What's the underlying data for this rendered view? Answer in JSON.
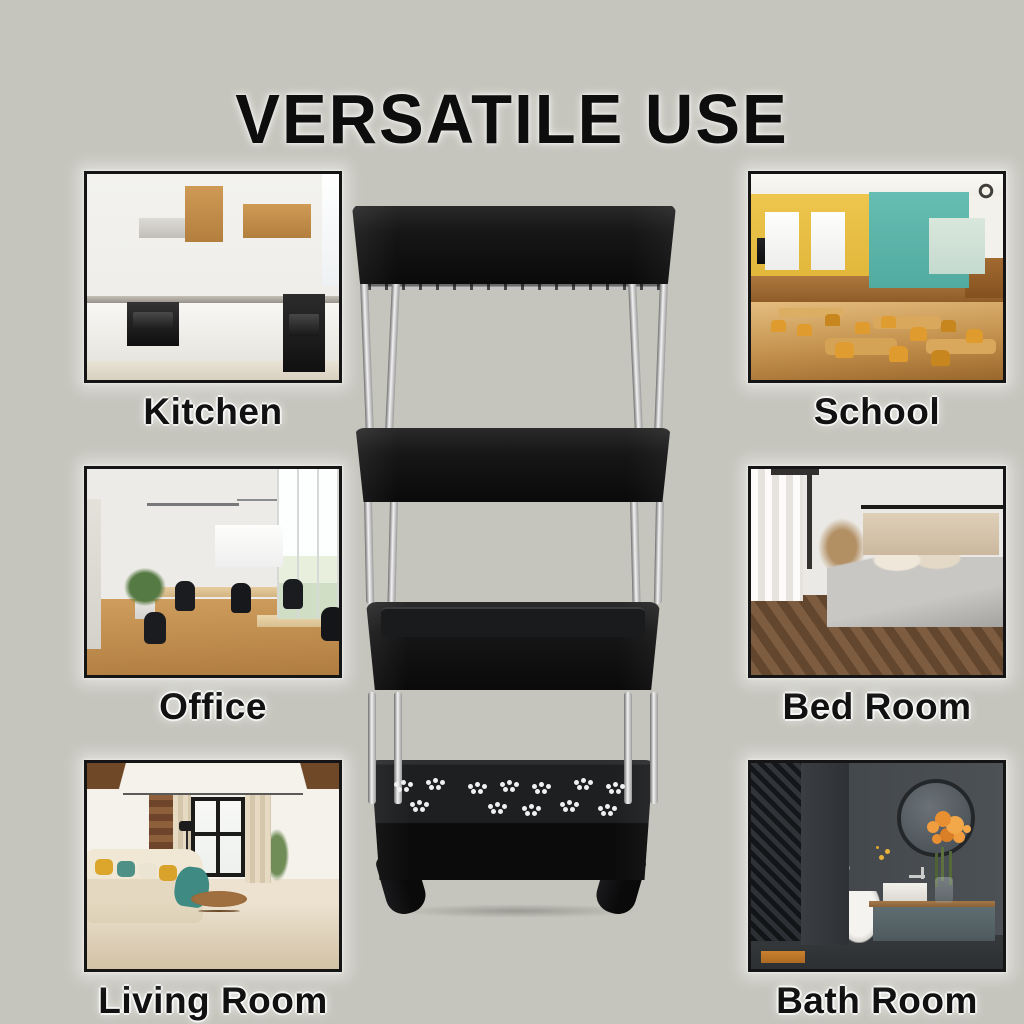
{
  "title": "VERSATILE USE",
  "rooms": [
    {
      "id": "kitchen",
      "label": "Kitchen"
    },
    {
      "id": "school",
      "label": "School"
    },
    {
      "id": "office",
      "label": "Office"
    },
    {
      "id": "bed-room",
      "label": "Bed Room"
    },
    {
      "id": "living-room",
      "label": "Living Room"
    },
    {
      "id": "bath-room",
      "label": "Bath Room"
    }
  ],
  "product": {
    "name": "4-tier black rolling storage cart with wheels",
    "tier_count": 4,
    "body_color": "#121214",
    "pole_color": "#c9c9c9"
  },
  "colors": {
    "background": "#c6c5bd",
    "title_text": "#0d0d0d",
    "label_text": "#111111",
    "photo_frame": "#151515"
  }
}
